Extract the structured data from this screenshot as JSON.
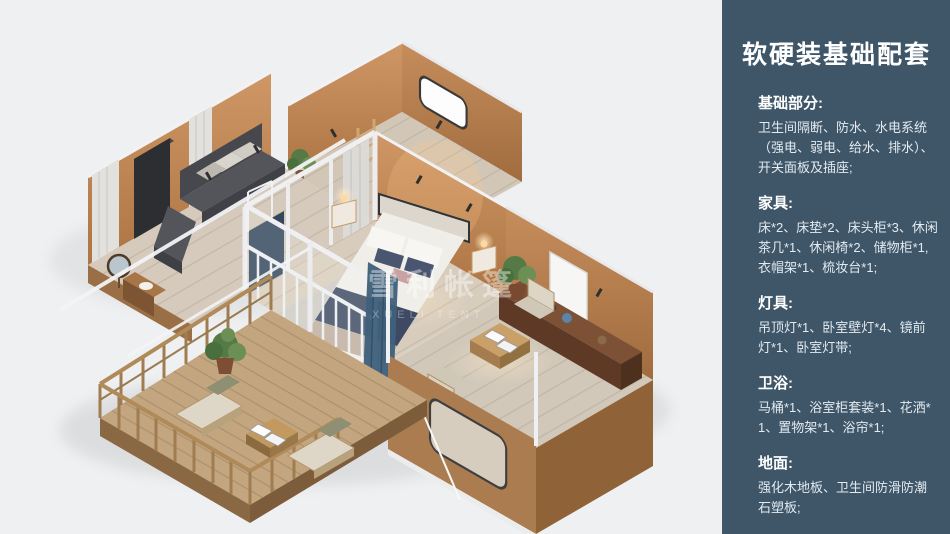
{
  "panel": {
    "title": "软硬装基础配套",
    "sections": [
      {
        "heading": "基础部分:",
        "body": "卫生间隔断、防水、水电系统（强电、弱电、给水、排水）、开关面板及插座;"
      },
      {
        "heading": "家具:",
        "body": "床*2、床垫*2、床头柜*3、休闲茶几*1、休闲椅*2、储物柜*1,衣帽架*1、梳妆台*1;"
      },
      {
        "heading": "灯具:",
        "body": "吊顶灯*1、卧室壁灯*4、镜前灯*1、卧室灯带;"
      },
      {
        "heading": "卫浴:",
        "body": "马桶*1、浴室柜套装*1、花洒*1、置物架*1、浴帘*1;"
      },
      {
        "heading": "地面:",
        "body": "强化木地板、卫生间防滑防潮石塑板;"
      }
    ]
  },
  "illustration": {
    "watermark_cn": "雪利帐篷",
    "watermark_en": "XUELI TENT"
  },
  "colors": {
    "bg": "#eff0f1",
    "panel_bg": "#3e5668",
    "wall_orange": "#b97d4b",
    "wall_exterior": "#ab7c50",
    "floor_wood": "#d5cabb",
    "deck_wood": "#c3a67f",
    "bed_navy": "#3e4a64",
    "curtain_teal": "#40617c",
    "plant_green": "#567a45",
    "beam_white": "#f3f4f6"
  }
}
